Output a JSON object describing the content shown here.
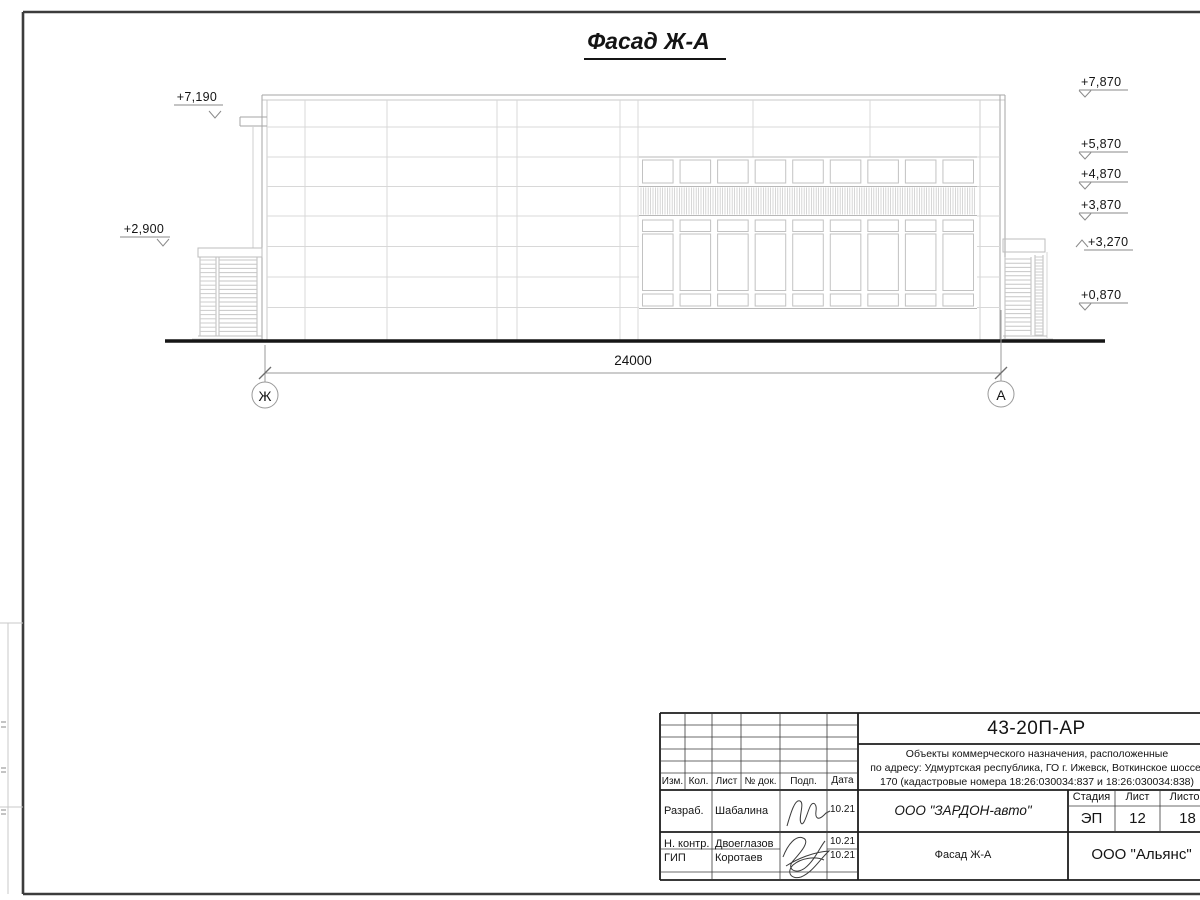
{
  "drawing_title": "Фасад Ж-А",
  "dimension": {
    "value": "24000"
  },
  "axes": {
    "left": "Ж",
    "right": "А"
  },
  "elevation_marks": {
    "left": [
      "+7,190",
      "+2,900"
    ],
    "right": [
      "+7,870",
      "+5,870",
      "+4,870",
      "+3,870",
      "+3,270",
      "+0,870"
    ]
  },
  "title_block": {
    "doc_number": "43-20П-АР",
    "project_description": {
      "line1": "Объекты коммерческого назначения, расположенные",
      "line2": "по адресу: Удмуртская республика, ГО г. Ижевск, Воткинское шоссе,",
      "line3": "170 (кадастровые номера 18:26:030034:837 и 18:26:030034:838)"
    },
    "columns": {
      "izm": "Изм.",
      "kol": "Кол.",
      "list": "Лист",
      "doc": "№ док.",
      "podp": "Подп.",
      "data": "Дата"
    },
    "signature_rows": [
      {
        "role": "Разраб.",
        "name": "Шабалина",
        "date": "10.21"
      },
      {
        "role": "Н. контр.",
        "name": "Двоеглазов",
        "date": "10.21"
      },
      {
        "role": "ГИП",
        "name": "Коротаев",
        "date": "10.21"
      }
    ],
    "developer": "ООО \"ЗАРДОН-авто\"",
    "stage": {
      "label": "Стадия",
      "value": "ЭП"
    },
    "sheet": {
      "label": "Лист",
      "value": "12"
    },
    "sheets": {
      "label": "Листов",
      "value": "18"
    },
    "view_title": "Фасад Ж-А",
    "organization": "ООО \"Альянс\""
  }
}
